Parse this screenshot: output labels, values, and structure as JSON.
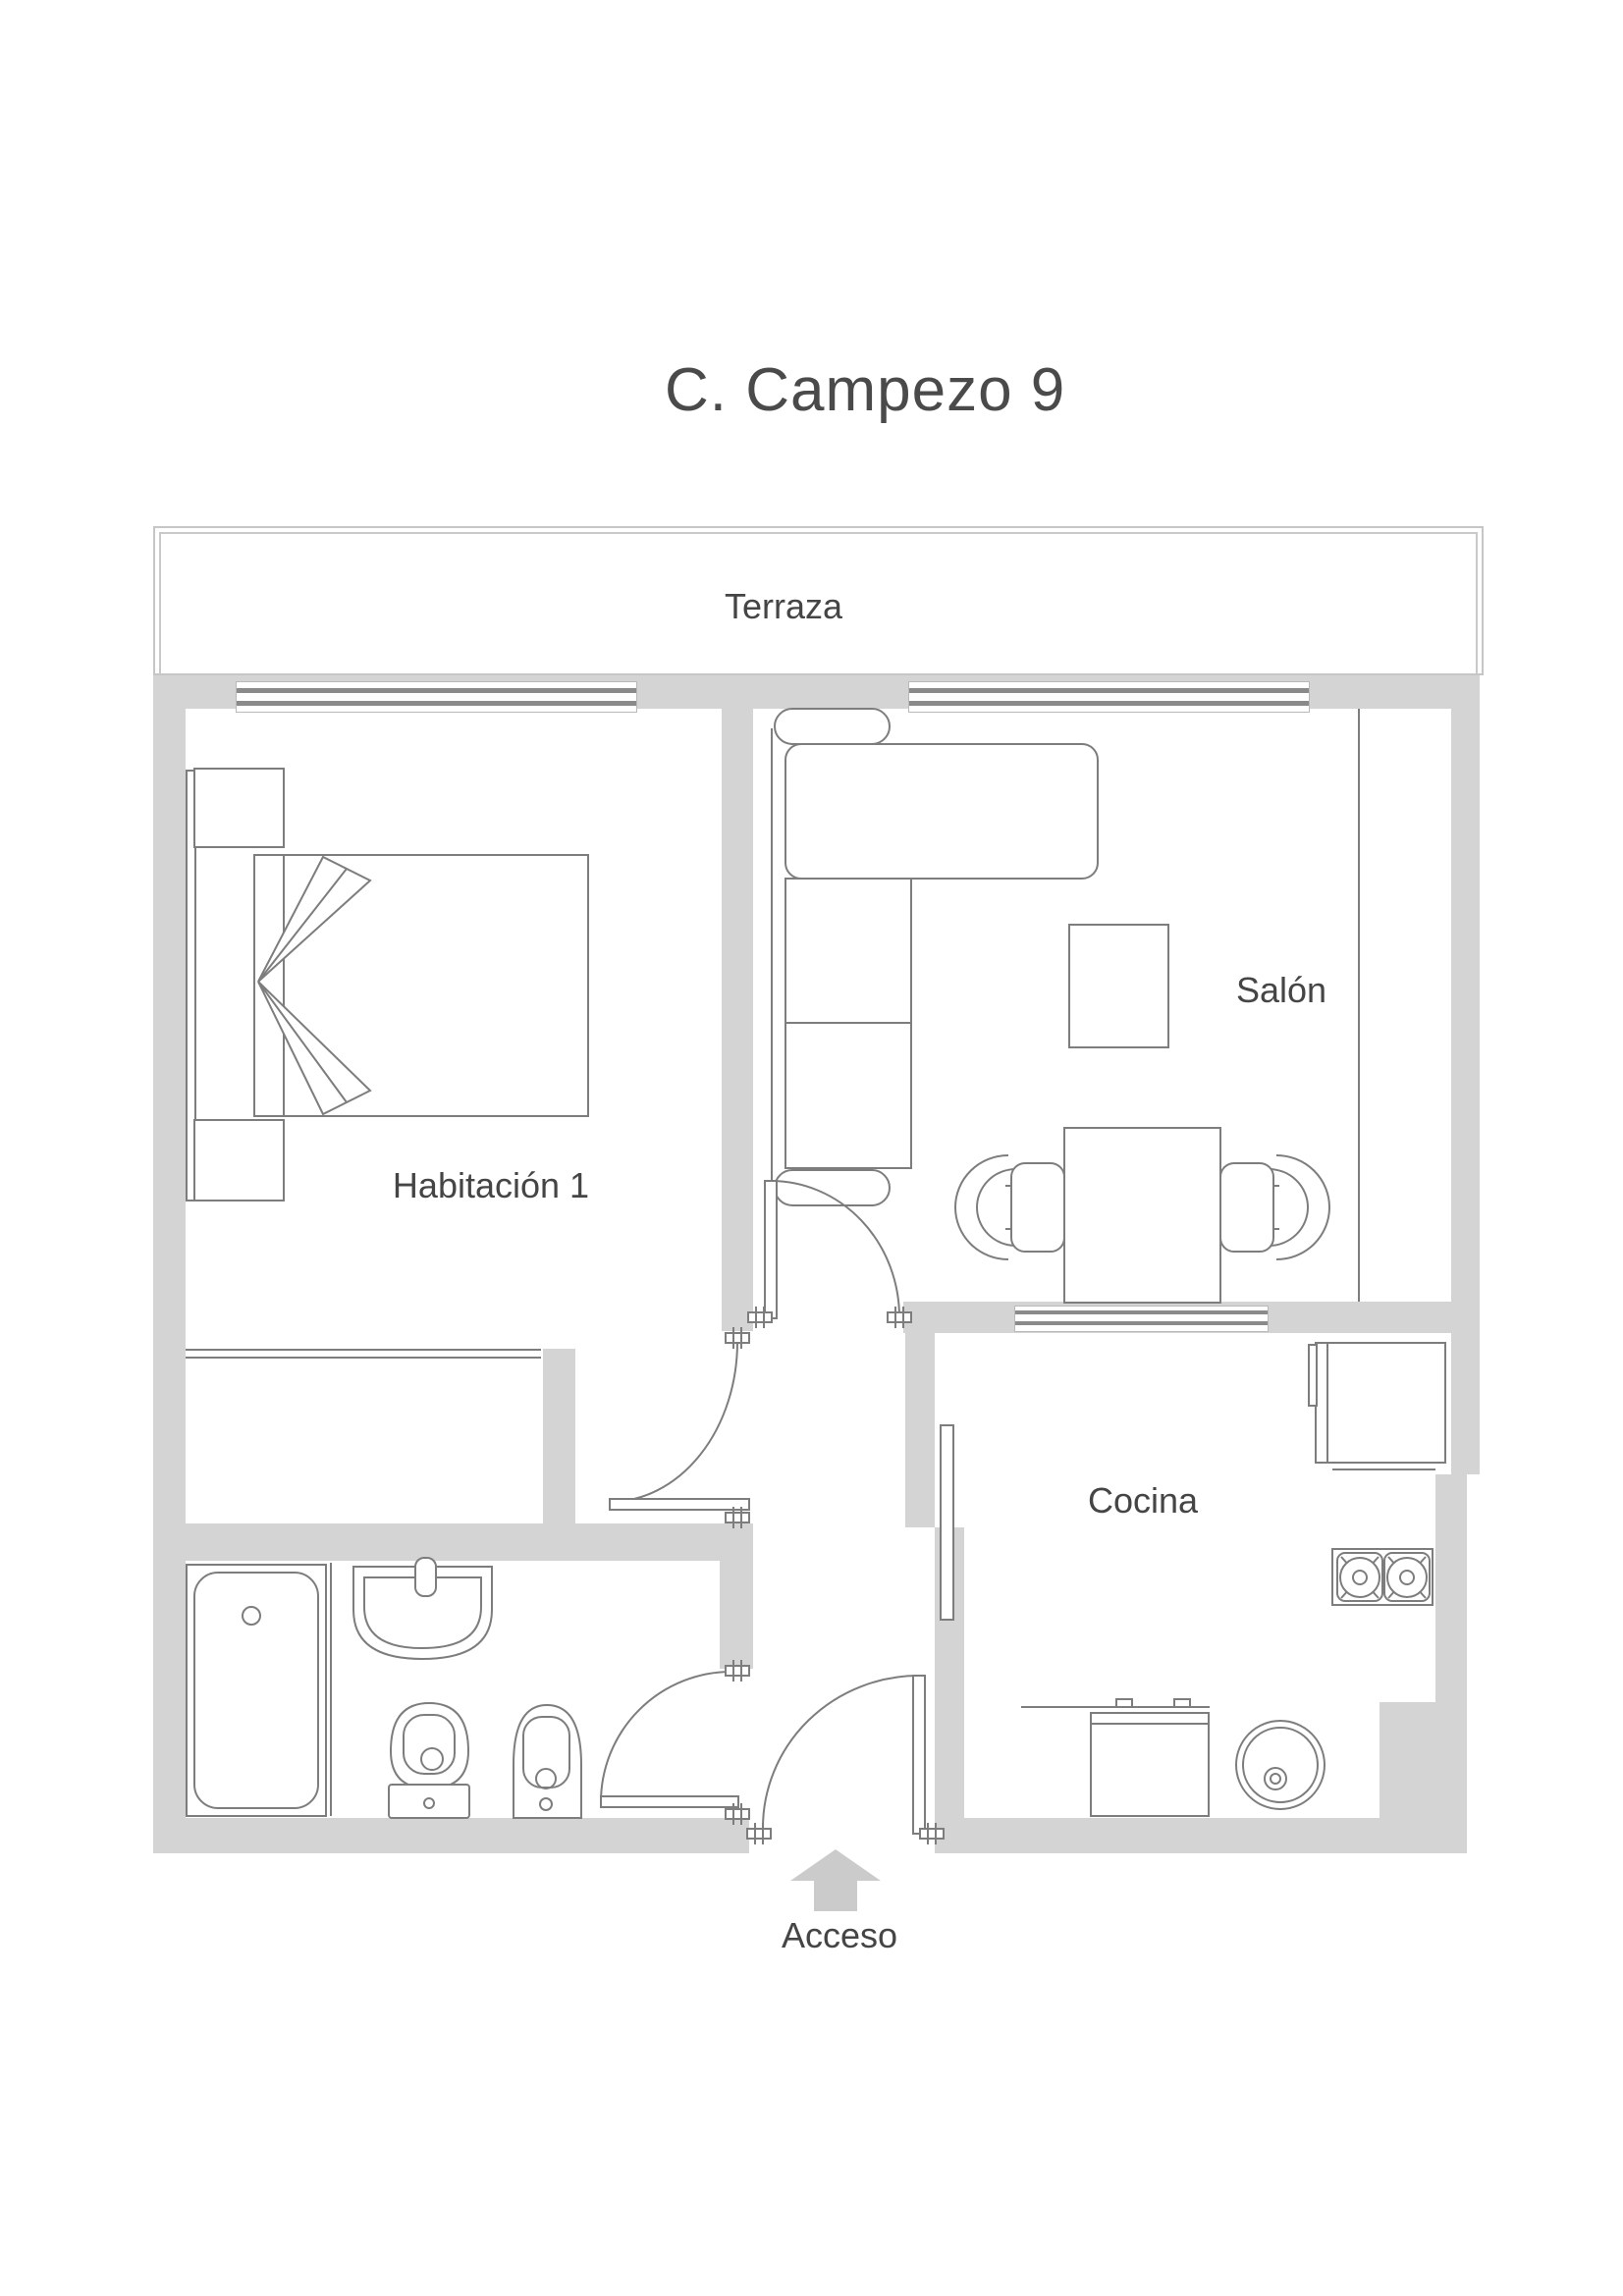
{
  "title": "C. Campezo 9",
  "rooms": {
    "terraza": "Terraza",
    "habitacion": "Habitación 1",
    "salon": "Salón",
    "cocina": "Cocina"
  },
  "entrance": {
    "label": "Acceso"
  },
  "colors": {
    "wall": "#d4d4d4",
    "furniture_line": "#7d7d7d",
    "window_line": "#8a8a8a",
    "text": "#454545",
    "arrow": "#cbcbcb"
  }
}
